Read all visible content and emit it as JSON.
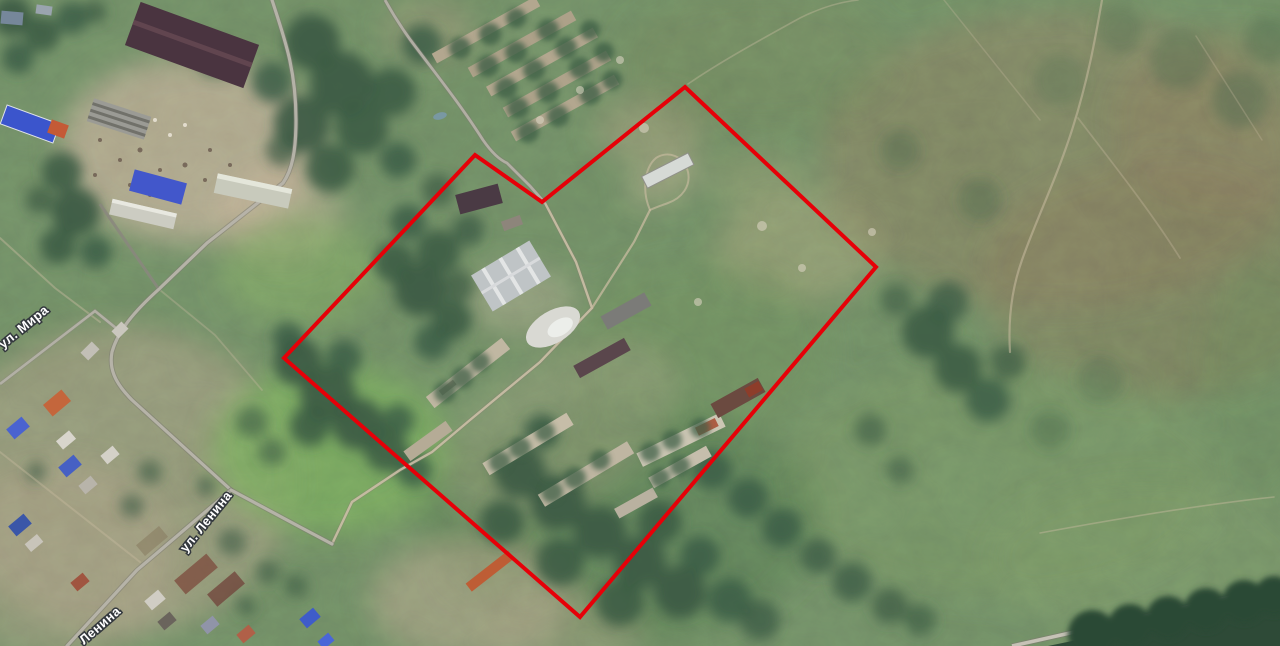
{
  "map": {
    "view_type": "satellite",
    "street_labels": [
      {
        "id": "mira",
        "text": "ул. Мира"
      },
      {
        "id": "lenina",
        "text": "ул. Ленина"
      },
      {
        "id": "lenina_partial",
        "text": "Ленина"
      }
    ],
    "parcel_boundary": {
      "points": "685,87 876,267 580,617 284,358 475,155 542,202",
      "stroke_color": "#e60008",
      "stroke_width": 4
    },
    "palette": {
      "field_green": "#74906a",
      "forest_green": "#3a5a43",
      "dark_forest": "#2e4a37",
      "dry_brown_field": "#8d8468",
      "village_ground": "#b9a691",
      "road_grey": "#b8b5ab",
      "dirt_track": "#c8bba0",
      "roof_blue": "#4058cc",
      "roof_dark_maroon": "#4a3440",
      "roof_white": "#d8d8d4",
      "roof_orange": "#c4663c",
      "boundary_red": "#e60008"
    }
  }
}
